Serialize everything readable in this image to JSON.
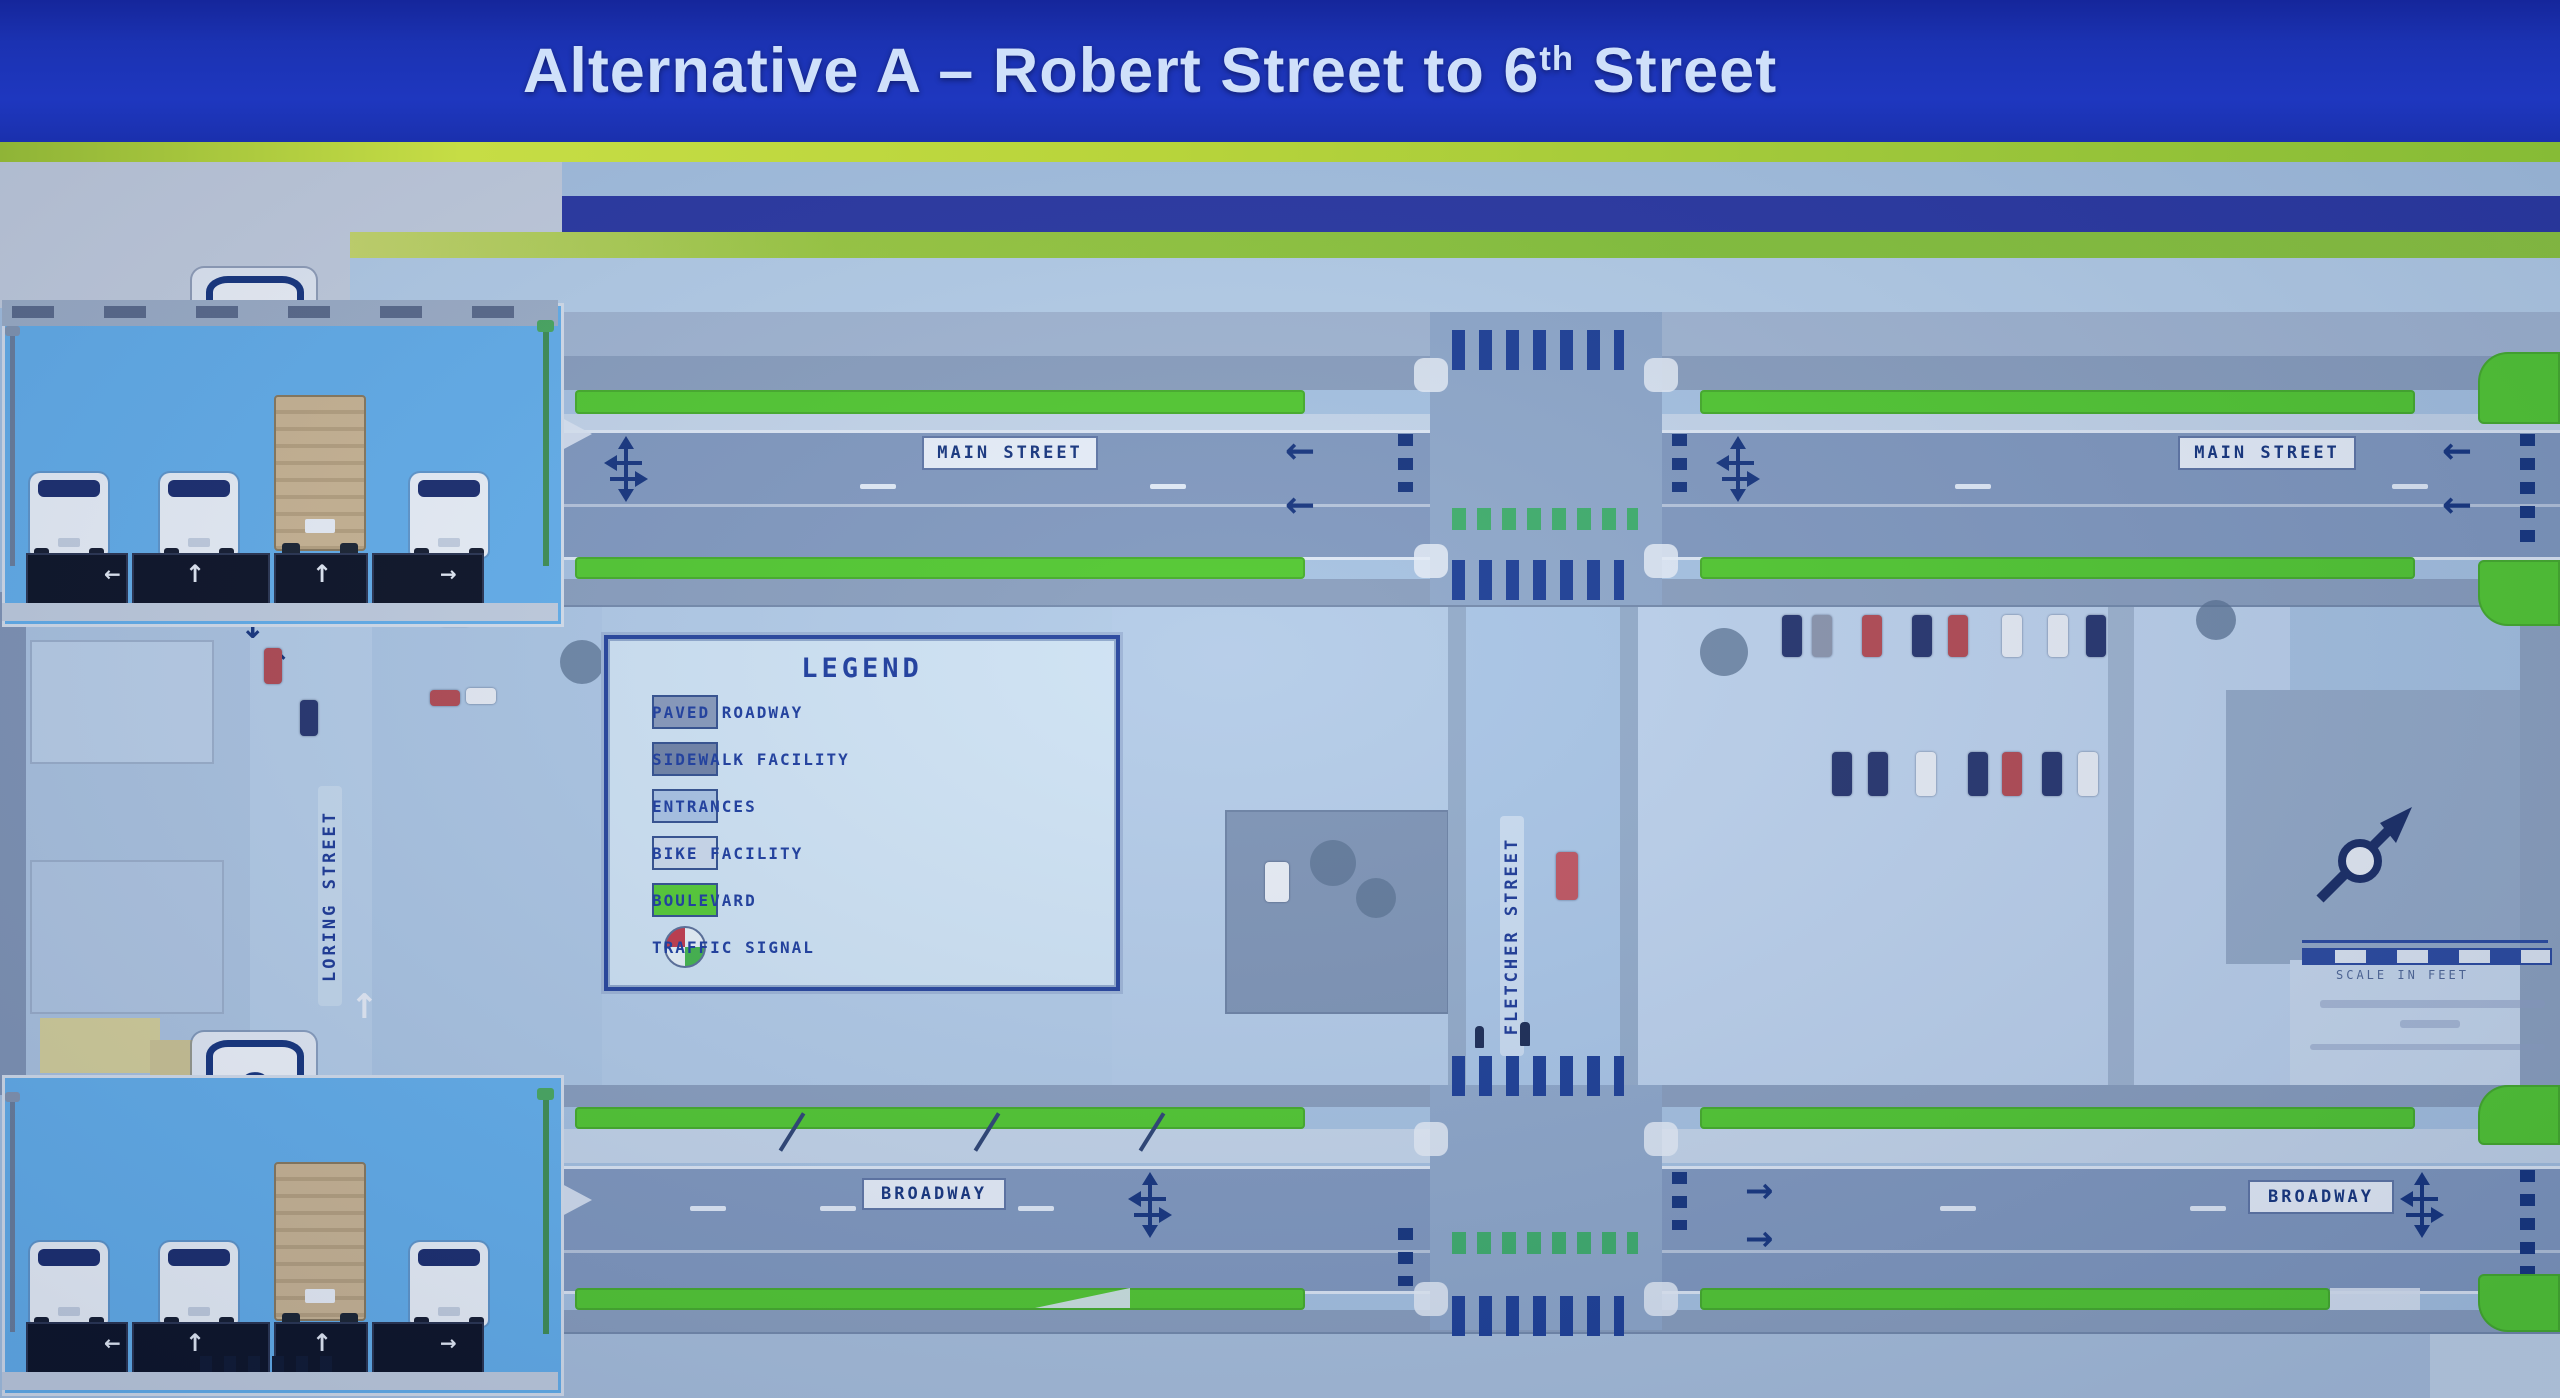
{
  "slide": {
    "title": {
      "prefix": "Alternative A – Robert Street to 6",
      "superscript": "th",
      "suffix": " Street"
    }
  },
  "legend": {
    "title": "LEGEND",
    "items": [
      {
        "label": "PAVED ROADWAY",
        "swatch_color": "#8799bb"
      },
      {
        "label": "SIDEWALK FACILITY",
        "swatch_color": "#6f82a6"
      },
      {
        "label": "ENTRANCES",
        "swatch_color": "#a9c3e4"
      },
      {
        "label": "BIKE FACILITY",
        "swatch_color": "#ccdaec"
      },
      {
        "label": "BOULEVARD",
        "swatch_color": "#55cb34"
      },
      {
        "label": "TRAFFIC SIGNAL",
        "swatch_color": "quartered circle red/white/green"
      }
    ]
  },
  "map": {
    "street_labels": {
      "main_street": "MAIN STREET",
      "broadway": "BROADWAY",
      "fletcher_street": "FLETCHER STREET",
      "loring_street": "LORING STREET"
    },
    "highway_shield_number": "2",
    "scale_caption": "SCALE IN FEET",
    "glyphs": {
      "arrow_left": "←",
      "arrow_right": "→",
      "arrow_up": "↑",
      "arrow_down": "↓"
    },
    "icons": {
      "traffic_signal_icon": "quartered circle (red/white/green)",
      "north_arrow_icon": "compass needle",
      "us_route_shield_icon": "US route shield badge"
    },
    "colors": {
      "title_bar_blue": "#1b32b2",
      "boulevard_green": "#52c92f",
      "paved_roadway": "#8199bf",
      "sidewalk": "#8a9fbe",
      "marking_navy": "#16357e",
      "aerial_base": "#a7c3e2",
      "panel_sky": "#64b0ec"
    }
  }
}
